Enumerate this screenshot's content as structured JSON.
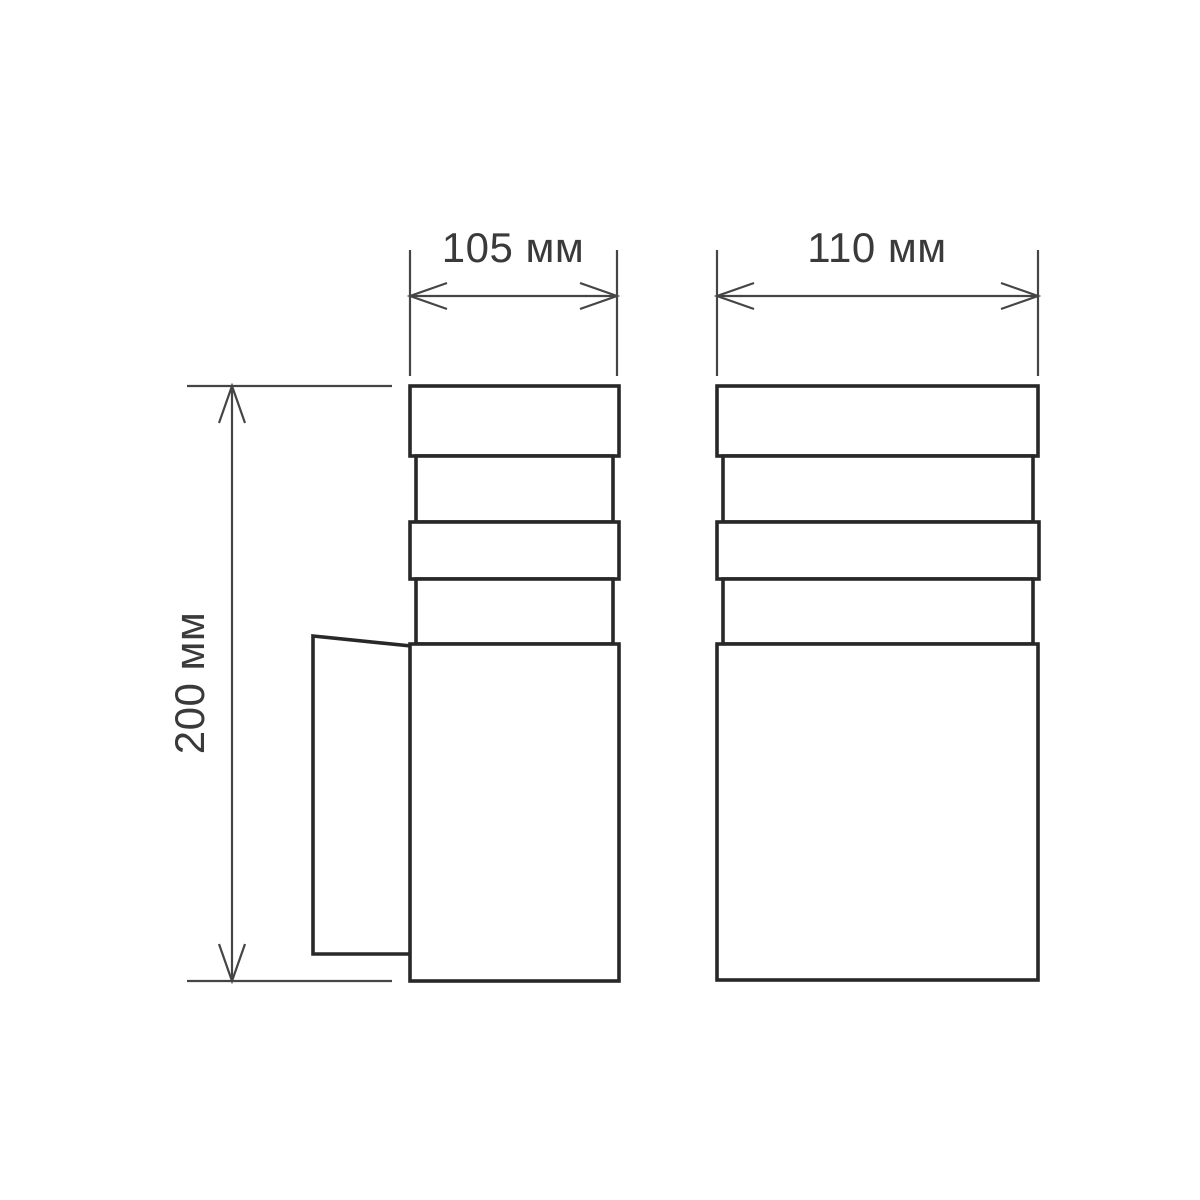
{
  "drawing": {
    "kind": "technical-dimension-drawing",
    "subject": "wall-lamp-two-views",
    "dimensions": {
      "side_width": {
        "label": "105 мм",
        "value": 105,
        "unit": "мм"
      },
      "front_width": {
        "label": "110 мм",
        "value": 110,
        "unit": "мм"
      },
      "height": {
        "label": "200 мм",
        "value": 200,
        "unit": "мм"
      }
    },
    "colors": {
      "background": "#ffffff",
      "outline": "#282828",
      "dimension": "#454545",
      "text": "#3a3a3a"
    }
  }
}
